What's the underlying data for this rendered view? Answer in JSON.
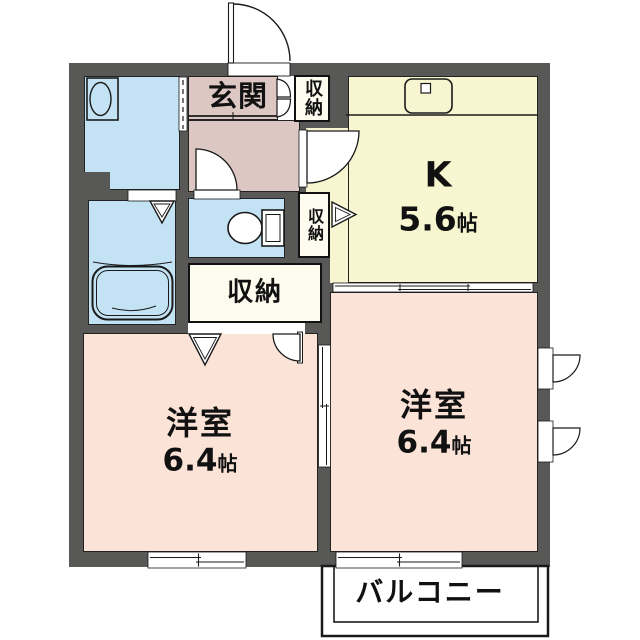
{
  "floorplan": {
    "entrance": {
      "label": "玄関"
    },
    "entrance_closet": {
      "label": "収納"
    },
    "toilet_closet": {
      "label": "収納"
    },
    "main_closet": {
      "label": "収納"
    },
    "kitchen": {
      "label": "K",
      "size_value": "5.6",
      "size_unit": "帖"
    },
    "room_left": {
      "label": "洋室",
      "size_value": "6.4",
      "size_unit": "帖"
    },
    "room_right": {
      "label": "洋室",
      "size_value": "6.4",
      "size_unit": "帖"
    },
    "balcony": {
      "label": "バルコニー"
    },
    "colors": {
      "wall": "#585856",
      "water_rooms": "#c3e2f4",
      "kitchen": "#f7f6d0",
      "western_rooms": "#fbe3d7",
      "entrance_hall": "#ddc7c3",
      "closet": "#fdfcee",
      "line": "#1a1a1a"
    },
    "fixtures": [
      "washbasin",
      "bathtub",
      "toilet",
      "kitchen-sink"
    ]
  }
}
